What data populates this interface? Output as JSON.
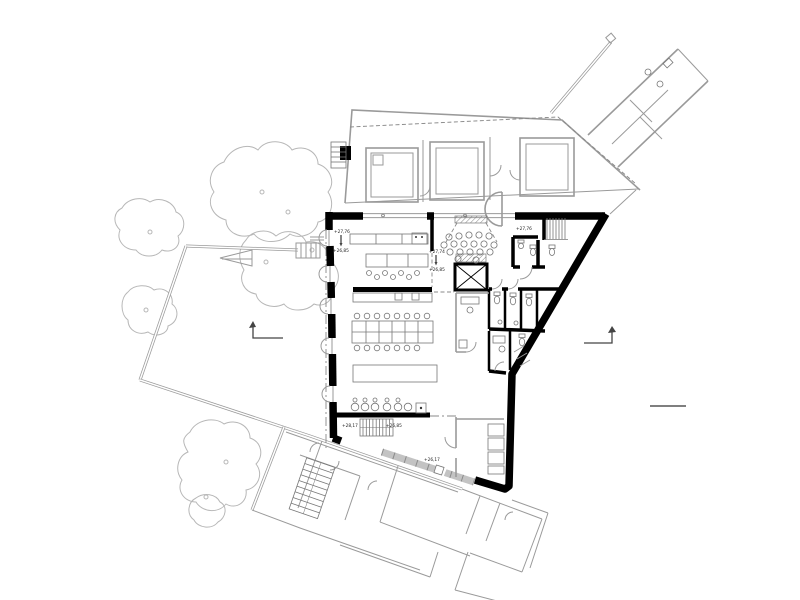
{
  "drawing": {
    "labels": [
      {
        "text": "+27,76"
      },
      {
        "text": "+26,85"
      },
      {
        "text": "+27,74"
      },
      {
        "text": "+26,85"
      },
      {
        "text": "+27,76"
      },
      {
        "text": "+28,17"
      },
      {
        "text": "+26,85"
      },
      {
        "text": "+26,17"
      }
    ]
  },
  "colors": {
    "wall": "#000000",
    "existing": "#9a9a9a",
    "vegetation": "#b7b7b7",
    "hatch": "#777777",
    "background": "#ffffff",
    "annotation": "#222222"
  }
}
